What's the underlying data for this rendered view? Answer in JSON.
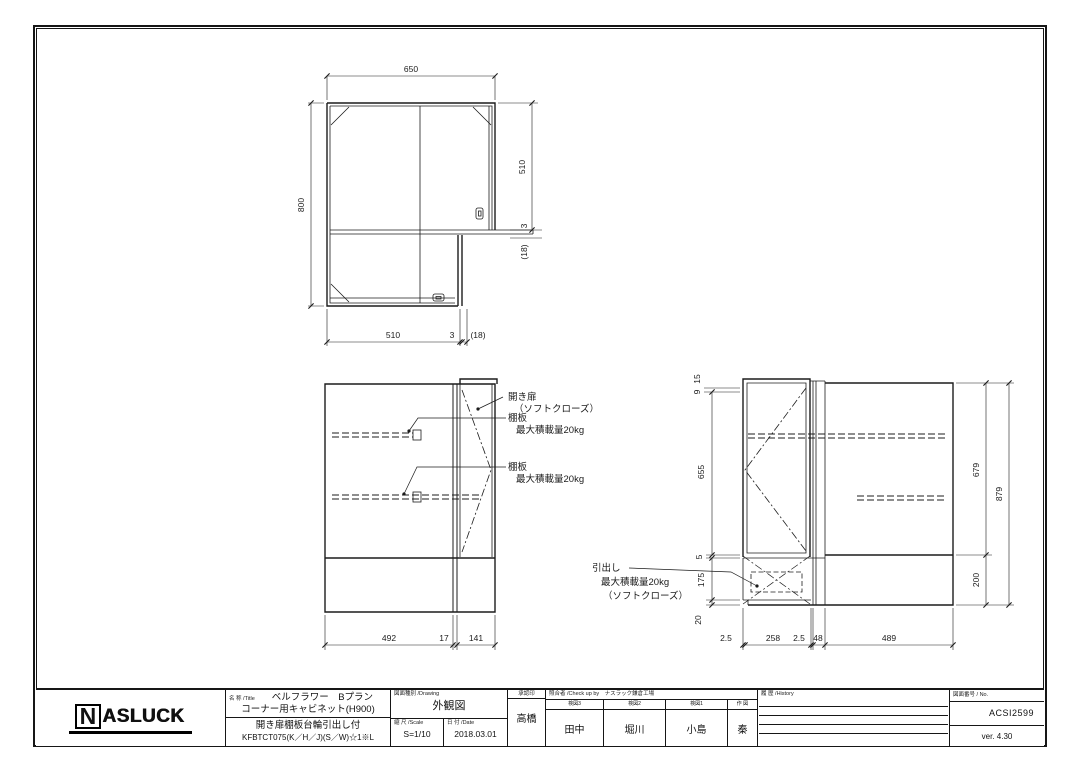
{
  "plan_view": {
    "dims": {
      "top": "650",
      "left": "800",
      "right_upper": "510",
      "right_gap": "3",
      "right_door": "(18)",
      "bottom_main": "510",
      "bottom_gap": "3",
      "bottom_door": "(18)"
    }
  },
  "front_view": {
    "dims": {
      "left": "492",
      "gap": "17",
      "door": "141"
    },
    "labels": {
      "door1": "開き扉",
      "door2": "（ソフトクローズ）",
      "shelf1": "棚板",
      "shelf1_load": "最大積載量20kg",
      "shelf2": "棚板",
      "shelf2_load": "最大積載量20kg"
    }
  },
  "side_view": {
    "dims": {
      "top_a": "15",
      "top_b": "9",
      "door_h": "655",
      "gap": "5",
      "drawer_h": "175",
      "base_gap": "20",
      "inner_h": "679",
      "total_h": "879",
      "base_h": "200",
      "b1": "2.5",
      "b2": "258",
      "b3": "2.5",
      "b4": "48",
      "b5": "489"
    },
    "labels": {
      "drawer1": "引出し",
      "drawer2": "最大積載量20kg",
      "drawer3": "（ソフトクローズ）"
    }
  },
  "title_block": {
    "logo_n": "N",
    "logo_rest": "ASLUCK",
    "title": {
      "header": "名 称 /Title",
      "line1": "ベルフラワー　Bプラン",
      "line2": "コーナー用キャビネット(H900)",
      "line3": "開き扉棚板台輪引出し付",
      "line4": "KFBTCT075(K／H／J)(S／W)☆1※L"
    },
    "drawing": {
      "header": "図面種別 /Drawing",
      "value": "外観図"
    },
    "scale": {
      "header": "縮 尺 /Scale",
      "value": "S=1/10"
    },
    "date": {
      "header": "日 付 /Date",
      "value": "2018.03.01"
    },
    "approval": {
      "header": "承認印",
      "name": "高橋"
    },
    "check": {
      "header": "照合者 /Check up by　ナスラック鎌倉工場",
      "columns": [
        {
          "label": "検図3",
          "name": "田中"
        },
        {
          "label": "検図2",
          "name": "堀川"
        },
        {
          "label": "検図1",
          "name": "小島"
        },
        {
          "label": "作 図",
          "name": "秦"
        }
      ]
    },
    "history": {
      "header": "履 歴 /History"
    },
    "number": {
      "header": "図面番号 / No.",
      "value": "ACSI2599",
      "version": "ver. 4.30"
    }
  }
}
